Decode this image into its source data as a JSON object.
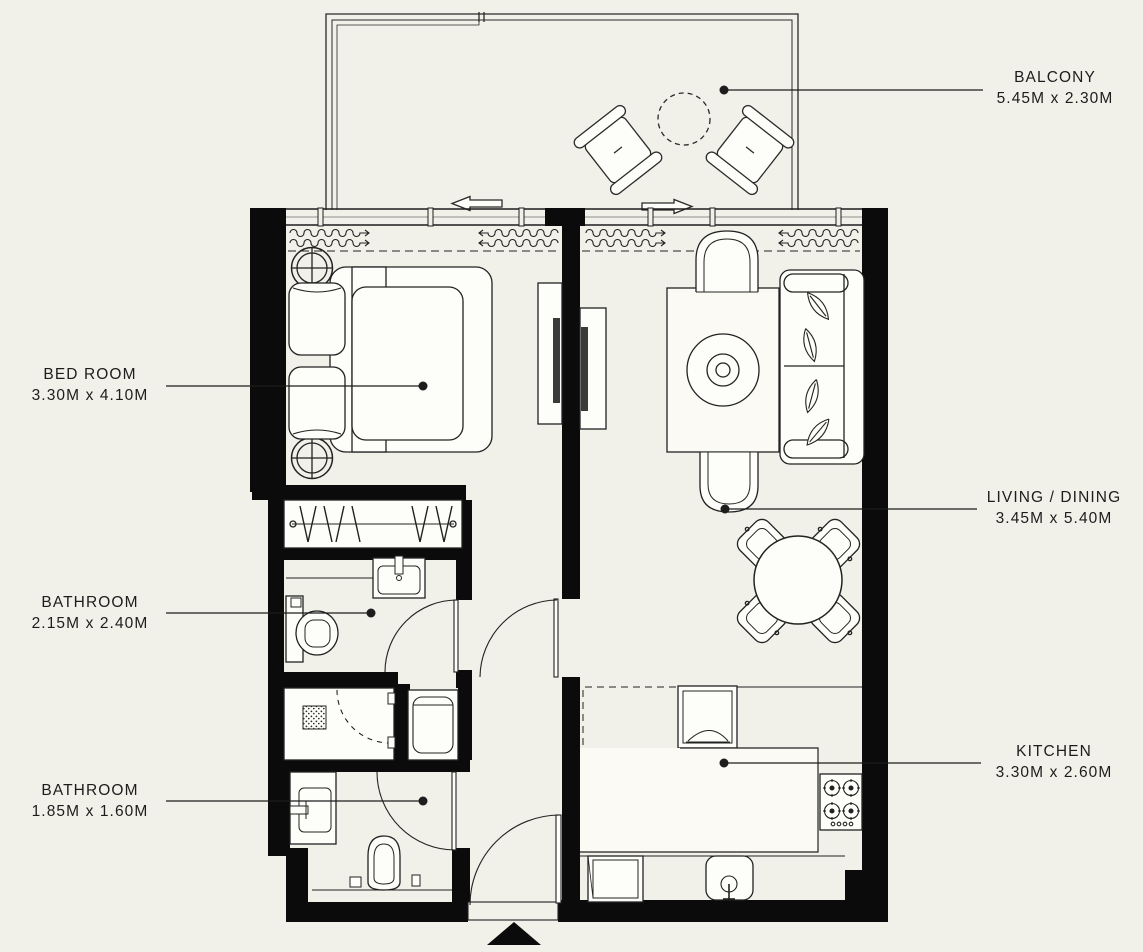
{
  "document": {
    "type": "apartment-floor-plan"
  },
  "colors": {
    "background": "#f1f0e9",
    "wall": "#0b0b0b",
    "line": "#1e1e1e",
    "furniture_fill": "#fdfdfa",
    "text": "#1d1d1d"
  },
  "rooms": [
    {
      "id": "balcony",
      "name": "BALCONY",
      "dimensions": "5.45M x 2.30M",
      "furniture": [
        "outdoor-chair",
        "outdoor-chair",
        "round-table",
        "sliding-door-arrows"
      ]
    },
    {
      "id": "bedroom",
      "name": "BED ROOM",
      "dimensions": "3.30M x 4.10M",
      "furniture": [
        "double-bed",
        "pillows",
        "bedside-lamp",
        "bedside-lamp",
        "curtains",
        "tv-unit"
      ]
    },
    {
      "id": "living-dining",
      "name": "LIVING / DINING",
      "dimensions": "3.45M x 5.40M",
      "furniture": [
        "sofa",
        "armchair",
        "armchair",
        "rug-with-coffee-table",
        "dining-table",
        "dining-chairs",
        "tv-unit",
        "curtains"
      ]
    },
    {
      "id": "bathroom-1",
      "name": "BATHROOM",
      "dimensions": "2.15M x 2.40M",
      "furniture": [
        "wash-basin",
        "toilet",
        "door"
      ]
    },
    {
      "id": "bathroom-2",
      "name": "BATHROOM",
      "dimensions": "1.85M x 1.60M",
      "furniture": [
        "wash-basin",
        "toilet",
        "shelf",
        "door"
      ]
    },
    {
      "id": "kitchen",
      "name": "KITCHEN",
      "dimensions": "3.30M x 2.60M",
      "furniture": [
        "refrigerator",
        "counter",
        "gas-hob",
        "sink",
        "dishwasher"
      ]
    }
  ],
  "extras": {
    "closet": "wardrobe-with-hanging-rail",
    "shower": "shower-stall-with-drain",
    "laundry": "washing-machine",
    "entry": "entrance-door-with-direction-triangle"
  }
}
